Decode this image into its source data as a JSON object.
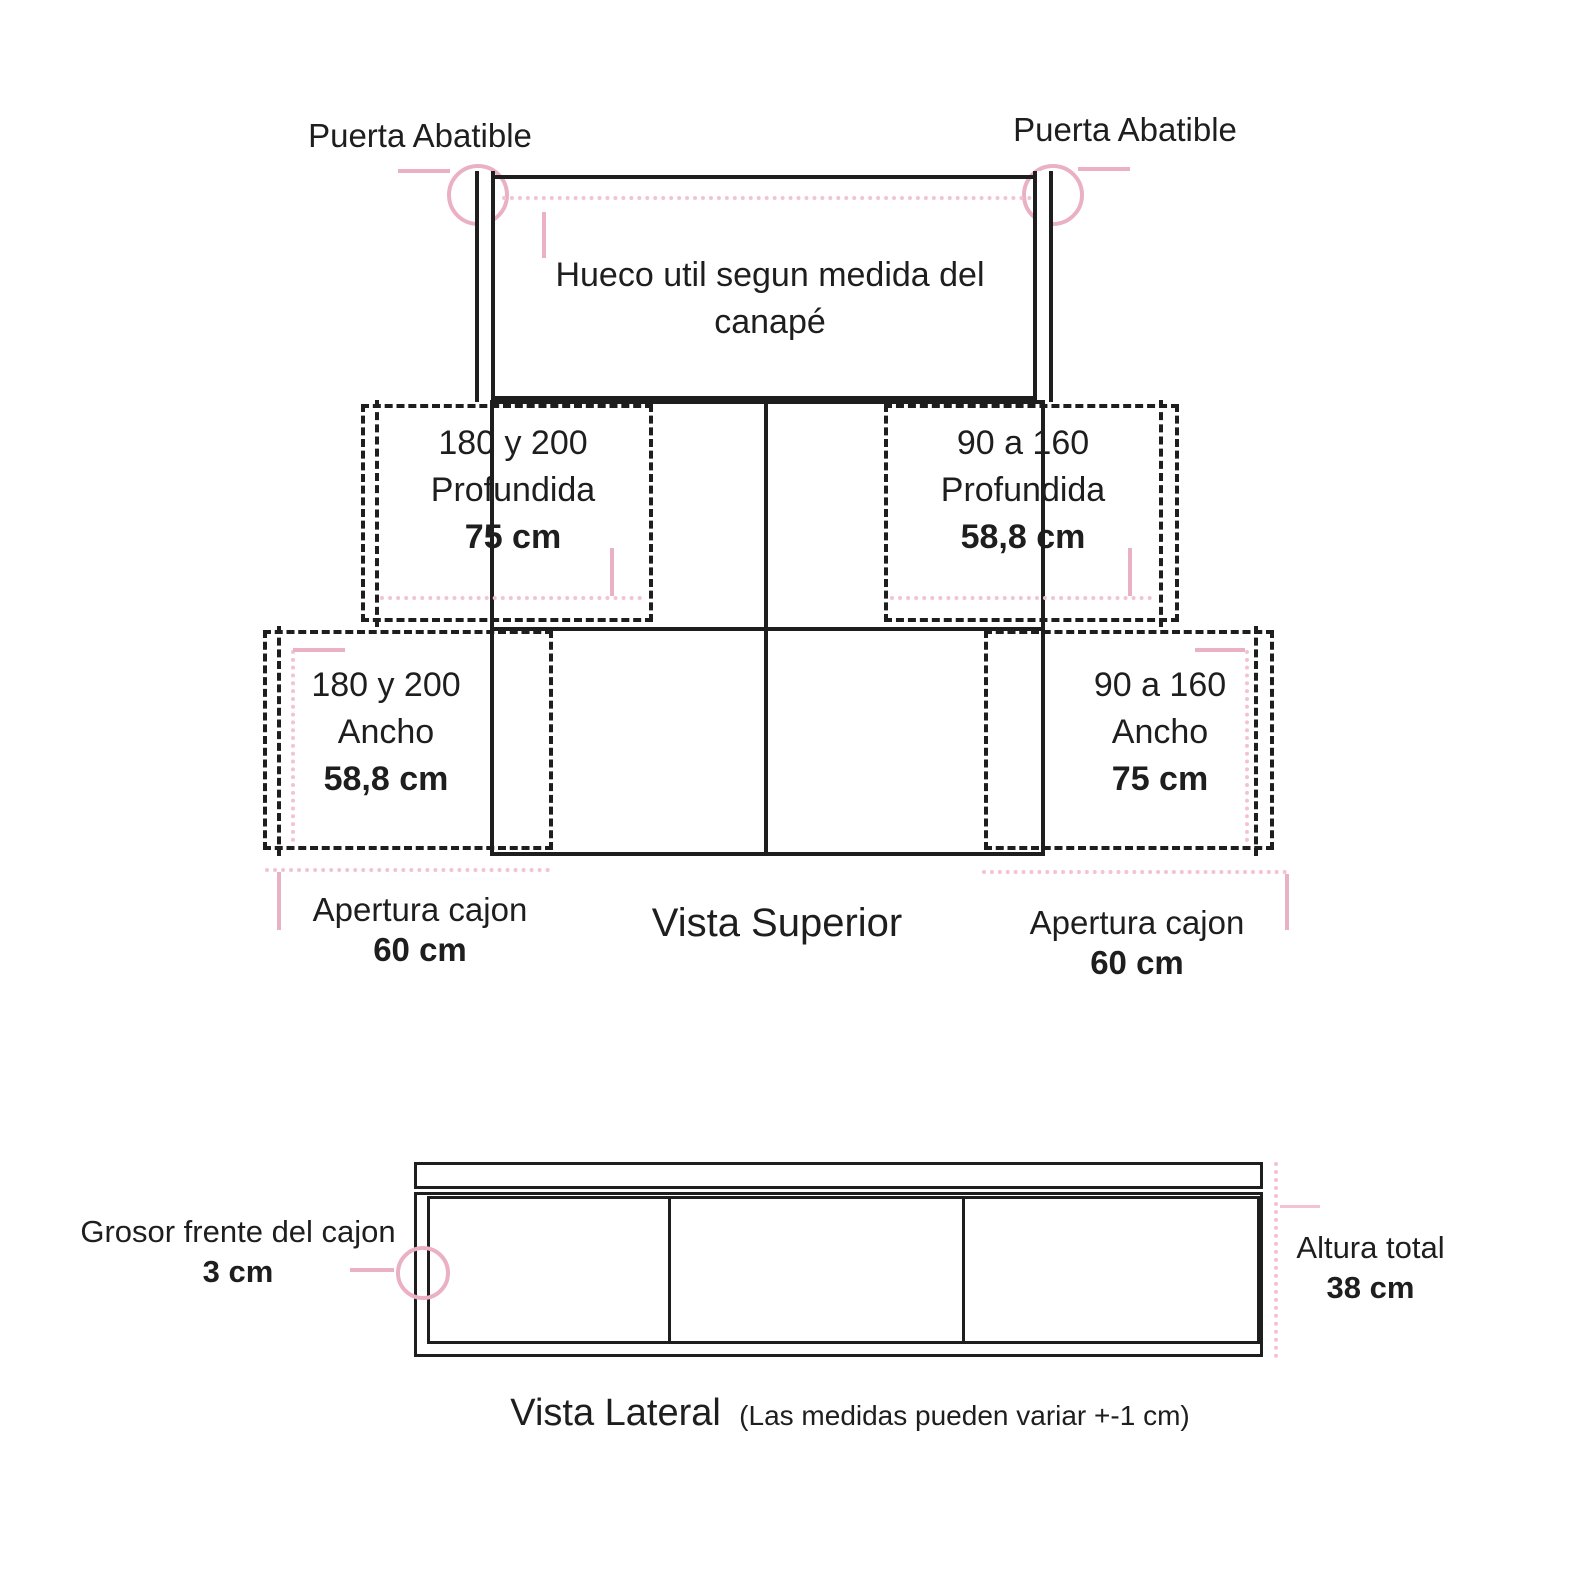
{
  "colors": {
    "line": "#1e1e1e",
    "accent_pink": "#eab0c3",
    "accent_pink_light": "#f3c3d2"
  },
  "top_view": {
    "title": "Vista Superior",
    "puerta_left": "Puerta Abatible",
    "puerta_right": "Puerta Abatible",
    "hueco_line1": "Hueco util segun medida del",
    "hueco_line2": "canapé",
    "mid_left": {
      "range": "180 y 200",
      "dim": "Profundida",
      "value": "75 cm"
    },
    "mid_right": {
      "range": "90 a 160",
      "dim": "Profundida",
      "value": "58,8 cm"
    },
    "low_left": {
      "range": "180 y 200",
      "dim": "Ancho",
      "value": "58,8 cm"
    },
    "low_right": {
      "range": "90 a 160",
      "dim": "Ancho",
      "value": "75 cm"
    },
    "apertura_left": {
      "label": "Apertura cajon",
      "value": "60 cm"
    },
    "apertura_right": {
      "label": "Apertura cajon",
      "value": "60 cm"
    }
  },
  "side_view": {
    "title": "Vista Lateral",
    "note": "(Las medidas pueden variar +-1 cm)",
    "grosor_label": "Grosor frente del cajon",
    "grosor_value": "3 cm",
    "altura_label": "Altura total",
    "altura_value": "38 cm"
  }
}
